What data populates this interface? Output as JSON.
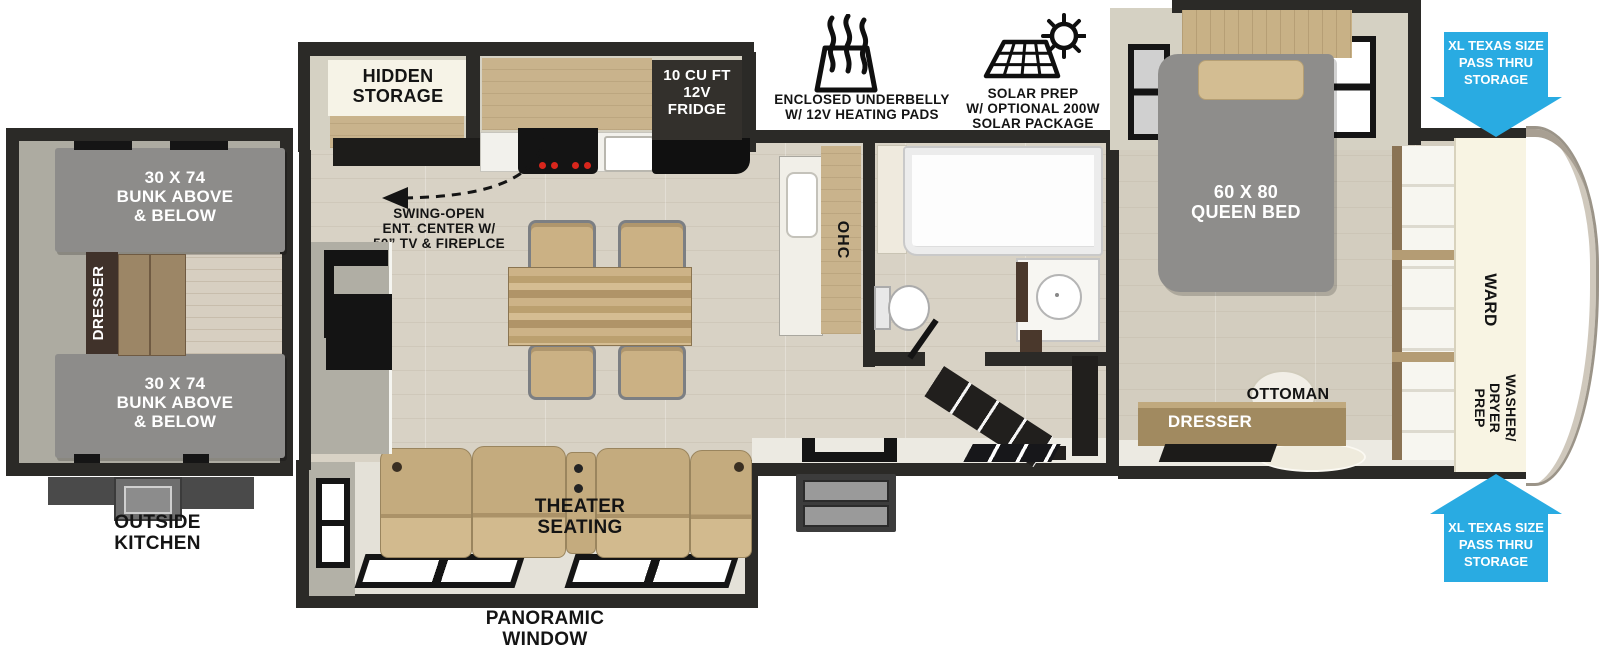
{
  "callouts": {
    "underbelly_label": "ENCLOSED UNDERBELLY\nW/ 12V HEATING PADS",
    "solar_label": "SOLAR PREP\nW/ OPTIONAL 200W\nSOLAR PACKAGE",
    "pass_thru_top": "XL TEXAS SIZE\nPASS THRU\nSTORAGE",
    "pass_thru_bottom": "XL TEXAS SIZE\nPASS THRU\nSTORAGE",
    "swing_open": "SWING-OPEN\nENT. CENTER W/\n50” TV & FIREPLCE",
    "outside_kitchen": "OUTSIDE\nKITCHEN",
    "panoramic_window": "PANORAMIC\nWINDOW"
  },
  "bunk_room": {
    "bunk_top": "30 X 74\nBUNK ABOVE\n& BELOW",
    "bunk_bottom": "30 X 74\nBUNK ABOVE\n& BELOW",
    "dresser": "DRESSER"
  },
  "kitchen": {
    "hidden_storage": "HIDDEN\nSTORAGE",
    "fridge": "10 CU FT\n12V\nFRIDGE",
    "ohc": "OHC"
  },
  "living": {
    "theater_seating": "THEATER\nSEATING"
  },
  "bedroom": {
    "queen_bed": "60 X 80\nQUEEN BED",
    "ottoman": "OTTOMAN",
    "dresser": "DRESSER",
    "ward": "WARD",
    "washer_dryer": "WASHER/\nDRYER\nPREP"
  },
  "icons": [
    "heat-waves-icon",
    "solar-panel-sun-icon",
    "pass-thru-arrow-down-icon",
    "pass-thru-arrow-up-icon",
    "swing-open-arrow-icon"
  ],
  "colors": {
    "wall": "#2b2a27",
    "accent_blue": "#29abe2",
    "bunk_gray": "#8d8c8a",
    "seat_tan": "#c4ab7e",
    "cabinet_wood": "#c9b38c",
    "floor_wood": "#d8d2c5",
    "dark_dresser": "#40322a"
  }
}
